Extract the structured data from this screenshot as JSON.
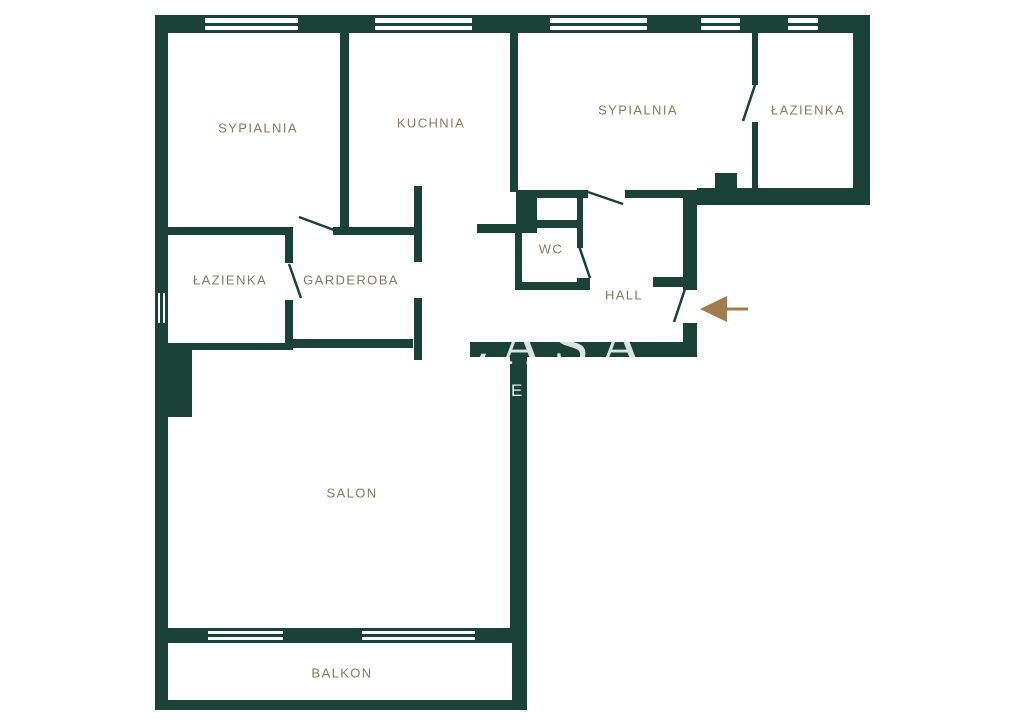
{
  "colors": {
    "wall": "#1a4237",
    "label": "#8c7a61",
    "arrow": "#a07c4e",
    "background": "#ffffff"
  },
  "rooms": [
    {
      "id": "bedroom-1",
      "label": "SYPIALNIA",
      "x": 258,
      "y": 128
    },
    {
      "id": "kitchen",
      "label": "KUCHNIA",
      "x": 431,
      "y": 123
    },
    {
      "id": "bedroom-2",
      "label": "SYPIALNIA",
      "x": 638,
      "y": 110
    },
    {
      "id": "bathroom-top",
      "label": "ŁAZIENKA",
      "x": 808,
      "y": 110
    },
    {
      "id": "bathroom-left",
      "label": "ŁAZIENKA",
      "x": 230,
      "y": 280
    },
    {
      "id": "wardrobe",
      "label": "GARDEROBA",
      "x": 351,
      "y": 280
    },
    {
      "id": "wc",
      "label": "WC",
      "x": 551,
      "y": 249
    },
    {
      "id": "hall",
      "label": "HALL",
      "x": 624,
      "y": 295
    },
    {
      "id": "living-room",
      "label": "SALON",
      "x": 352,
      "y": 493
    },
    {
      "id": "balcony",
      "label": "BALKON",
      "x": 342,
      "y": 673
    }
  ],
  "walls": [
    [
      155,
      15,
      50,
      18
    ],
    [
      298,
      15,
      77,
      18
    ],
    [
      472,
      15,
      78,
      18
    ],
    [
      647,
      15,
      54,
      18
    ],
    [
      740,
      15,
      48,
      18
    ],
    [
      818,
      15,
      52,
      18
    ],
    [
      155,
      15,
      13,
      695
    ],
    [
      853,
      15,
      17,
      190
    ],
    [
      697,
      188,
      173,
      17
    ],
    [
      683,
      190,
      14,
      100
    ],
    [
      683,
      323,
      14,
      34
    ],
    [
      470,
      342,
      227,
      15
    ],
    [
      510,
      345,
      17,
      298
    ],
    [
      512,
      643,
      15,
      67
    ],
    [
      155,
      700,
      372,
      10
    ],
    [
      155,
      628,
      53,
      15
    ],
    [
      283,
      628,
      79,
      15
    ],
    [
      475,
      628,
      52,
      15
    ],
    [
      340,
      33,
      9,
      194
    ],
    [
      510,
      33,
      8,
      159
    ],
    [
      516,
      192,
      21,
      41
    ],
    [
      168,
      227,
      125,
      8
    ],
    [
      333,
      227,
      84,
      8
    ],
    [
      414,
      186,
      8,
      76
    ],
    [
      414,
      298,
      8,
      62
    ],
    [
      477,
      224,
      40,
      9
    ],
    [
      515,
      233,
      7,
      57
    ],
    [
      537,
      220,
      40,
      8
    ],
    [
      577,
      192,
      6,
      56
    ],
    [
      577,
      278,
      13,
      12
    ],
    [
      515,
      282,
      75,
      8
    ],
    [
      517,
      190,
      71,
      8
    ],
    [
      625,
      190,
      58,
      8
    ],
    [
      715,
      173,
      22,
      17
    ],
    [
      752,
      33,
      6,
      52
    ],
    [
      752,
      122,
      6,
      66
    ],
    [
      653,
      277,
      30,
      10
    ],
    [
      285,
      235,
      8,
      28
    ],
    [
      285,
      300,
      8,
      50
    ],
    [
      168,
      343,
      125,
      7
    ],
    [
      293,
      339,
      120,
      9
    ],
    [
      168,
      348,
      24,
      69
    ]
  ],
  "windows": [
    {
      "x": 205,
      "y": 15,
      "w": 93,
      "h": 18,
      "dir": "h"
    },
    {
      "x": 375,
      "y": 15,
      "w": 97,
      "h": 18,
      "dir": "h"
    },
    {
      "x": 550,
      "y": 15,
      "w": 97,
      "h": 18,
      "dir": "h"
    },
    {
      "x": 701,
      "y": 15,
      "w": 39,
      "h": 18,
      "dir": "h"
    },
    {
      "x": 788,
      "y": 15,
      "w": 30,
      "h": 18,
      "dir": "h"
    },
    {
      "x": 208,
      "y": 628,
      "w": 75,
      "h": 15,
      "dir": "h"
    },
    {
      "x": 362,
      "y": 628,
      "w": 113,
      "h": 15,
      "dir": "h"
    },
    {
      "x": 155,
      "y": 293,
      "w": 13,
      "h": 30,
      "dir": "v"
    }
  ],
  "doors": [
    [
      299,
      217,
      334,
      230
    ],
    [
      289,
      264,
      301,
      298
    ],
    [
      579,
      246,
      590,
      278
    ],
    [
      588,
      192,
      623,
      204
    ],
    [
      755,
      85,
      743,
      121
    ],
    [
      685,
      289,
      674,
      322
    ]
  ],
  "entrance": {
    "triangle": [
      [
        700,
        309
      ],
      [
        727,
        296
      ],
      [
        727,
        322
      ]
    ],
    "tail": [
      727,
      309,
      748,
      309
    ]
  },
  "watermark": {
    "large": {
      "text": "CASA",
      "x": 448,
      "y": 314
    },
    "small": {
      "text": "E",
      "x": 511,
      "y": 381
    }
  }
}
